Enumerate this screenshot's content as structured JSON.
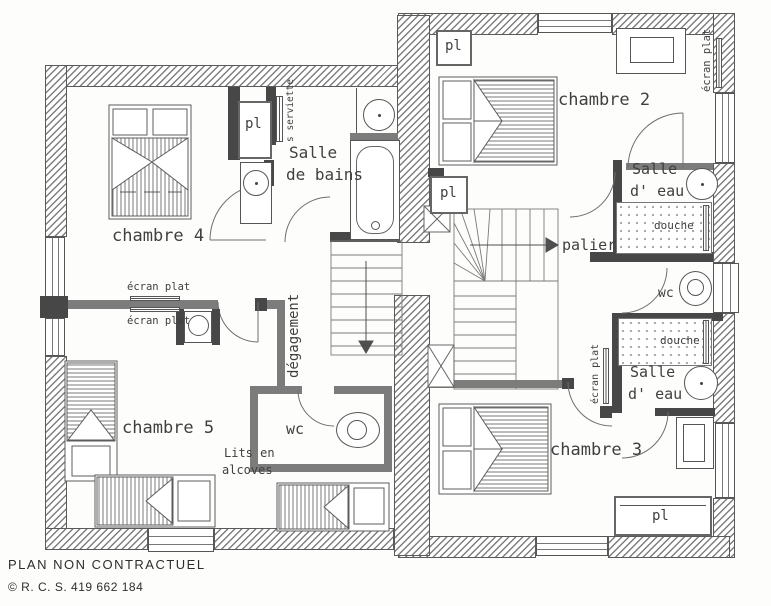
{
  "page": {
    "footer_line1": "PLAN NON CONTRACTUEL",
    "footer_line2": "© R. C. S. 419 662 184"
  },
  "rooms": {
    "chambre2": "chambre 2",
    "chambre3": "chambre 3",
    "chambre4": "chambre 4",
    "chambre5": "chambre 5",
    "salle_de_bains": {
      "line1": "Salle",
      "line2": "de bains"
    },
    "salle_eau_haut": {
      "line1": "Salle",
      "line2": "d' eau"
    },
    "salle_eau_bas": {
      "line1": "Salle",
      "line2": "d' eau"
    },
    "wc_gauche": "wc",
    "wc_droit": "wc",
    "palier": "palier",
    "degagement": "dégagement"
  },
  "annotations": {
    "pl_chambre4": "pl",
    "pl_chambre2": "pl",
    "pl_palier": "pl",
    "pl_chambre3": "pl",
    "ecran_plat_chambre4": "écran plat",
    "ecran_plat_chambre5": "écran plat",
    "ecran_plat_chambre2": "écran plat",
    "ecran_plat_chambre3": "écran plat",
    "seche_serviette": "s serviette",
    "douche_haut": "douche",
    "douche_bas": "douche",
    "lits_alcoves": {
      "line1": "Lits en",
      "line2": "alcoves"
    }
  },
  "colors": {
    "paper": "#fdfdfb",
    "hatch_grey": "#7e7e7e",
    "partition_grey": "#7c7c7c",
    "dark_wall": "#474747",
    "line": "#555555"
  }
}
